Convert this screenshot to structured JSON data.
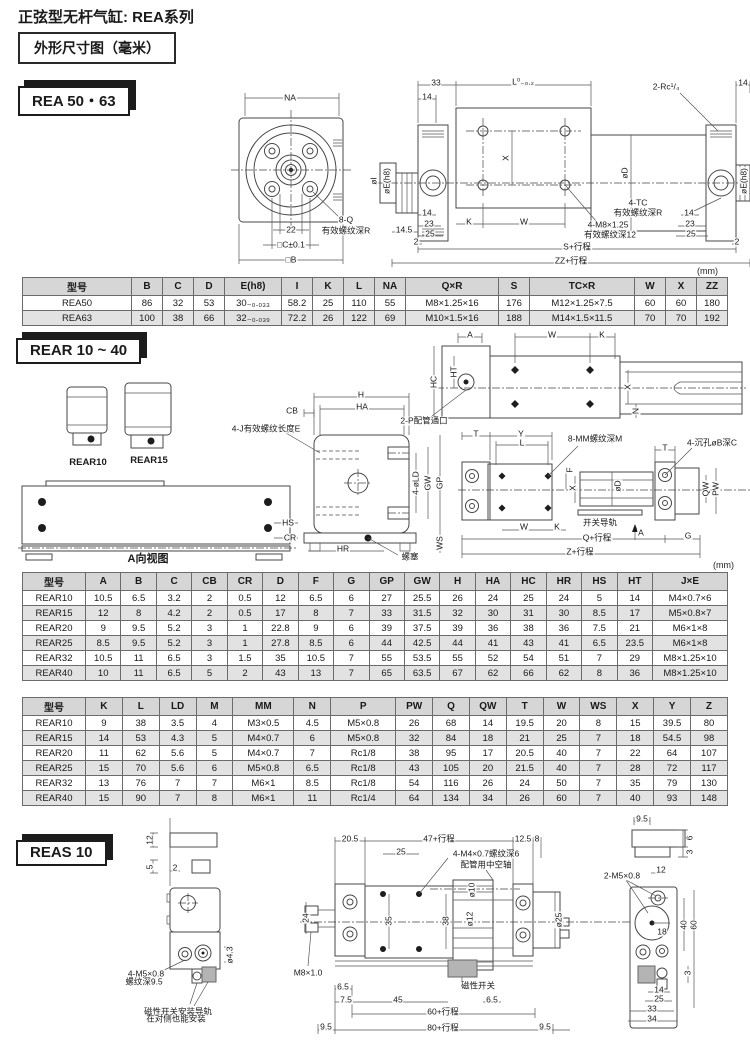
{
  "page": {
    "title": "正弦型无杆气缸: REA系列",
    "frame_title": "外形尺寸图（毫米）"
  },
  "sections": {
    "rea": {
      "badge": "REA 50・63"
    },
    "rear": {
      "badge": "REAR 10 ~ 40"
    },
    "reas": {
      "badge": "REAS 10"
    }
  },
  "labels": {
    "rea_front": [
      {
        "t": "NA",
        "x": 97,
        "y": 16
      },
      {
        "t": "22",
        "x": 98,
        "y": 148
      },
      {
        "t": "□C±0.1",
        "x": 98,
        "y": 163
      },
      {
        "t": "□B",
        "x": 98,
        "y": 178
      },
      {
        "t": "8-Q",
        "x": 153,
        "y": 138
      },
      {
        "t": "有效螺纹深R",
        "x": 153,
        "y": 149
      }
    ],
    "rea_side": [
      {
        "t": "33",
        "x": 70,
        "y": 10
      },
      {
        "t": "14",
        "x": 61,
        "y": 24
      },
      {
        "t": "L⁰₋₀.₂",
        "x": 157,
        "y": 9
      },
      {
        "t": "2-Rc¹/₄",
        "x": 300,
        "y": 14
      },
      {
        "t": "14",
        "x": 377,
        "y": 10
      },
      {
        "t": "X",
        "x": 140,
        "y": 85,
        "r": 1
      },
      {
        "t": "øD",
        "x": 259,
        "y": 100,
        "r": 1
      },
      {
        "t": "øI",
        "x": 8,
        "y": 108,
        "r": 1
      },
      {
        "t": "øE(h8)",
        "x": 21,
        "y": 108,
        "r": 1
      },
      {
        "t": "øE(h8)",
        "x": 378,
        "y": 108,
        "r": 1
      },
      {
        "t": "4-TC",
        "x": 272,
        "y": 130
      },
      {
        "t": "有效螺纹深R",
        "x": 272,
        "y": 140
      },
      {
        "t": "4-M8×1.25",
        "x": 242,
        "y": 152
      },
      {
        "t": "有效螺纹深12",
        "x": 244,
        "y": 162
      },
      {
        "t": "14",
        "x": 61,
        "y": 140
      },
      {
        "t": "23",
        "x": 63,
        "y": 151
      },
      {
        "t": "25",
        "x": 64,
        "y": 161
      },
      {
        "t": "14.5",
        "x": 38,
        "y": 157
      },
      {
        "t": "2",
        "x": 50,
        "y": 169
      },
      {
        "t": "K",
        "x": 103,
        "y": 149
      },
      {
        "t": "W",
        "x": 158,
        "y": 149
      },
      {
        "t": "14",
        "x": 323,
        "y": 140
      },
      {
        "t": "23",
        "x": 324,
        "y": 151
      },
      {
        "t": "25",
        "x": 325,
        "y": 161
      },
      {
        "t": "2",
        "x": 371,
        "y": 169
      },
      {
        "t": "S+行程",
        "x": 211,
        "y": 174
      },
      {
        "t": "ZZ+行程",
        "x": 205,
        "y": 188
      }
    ],
    "rear_small": [
      {
        "t": "REAR10",
        "x": 33,
        "y": 88,
        "fs": 9.5,
        "b": 1
      },
      {
        "t": "REAR15",
        "x": 94,
        "y": 86,
        "fs": 9.5,
        "b": 1
      }
    ],
    "rear_aview": [
      {
        "t": "HS",
        "x": 270,
        "y": 47
      },
      {
        "t": "CR",
        "x": 272,
        "y": 62
      },
      {
        "t": "A向视图",
        "x": 130,
        "y": 84,
        "fs": 11,
        "b": 1
      }
    ],
    "rear_body": [
      {
        "t": "H",
        "x": 65,
        "y": 12
      },
      {
        "t": "HA",
        "x": 66,
        "y": 24
      },
      {
        "t": "CB",
        "x": -4,
        "y": 28
      },
      {
        "t": "4-J有效螺纹长度E",
        "x": -30,
        "y": 46
      },
      {
        "t": "4-øLD",
        "x": 120,
        "y": 100,
        "r": 1
      },
      {
        "t": "GW",
        "x": 132,
        "y": 100,
        "r": 1
      },
      {
        "t": "GP",
        "x": 144,
        "y": 100,
        "r": 1
      },
      {
        "t": "WS",
        "x": 144,
        "y": 160,
        "r": 1
      },
      {
        "t": "HR",
        "x": 47,
        "y": 166
      },
      {
        "t": "螺塞",
        "x": 114,
        "y": 174
      }
    ],
    "rear_top": [
      {
        "t": "A",
        "x": 30,
        "y": 5
      },
      {
        "t": "W",
        "x": 112,
        "y": 5
      },
      {
        "t": "K",
        "x": 162,
        "y": 5
      },
      {
        "t": "HC",
        "x": -6,
        "y": 52,
        "r": 1
      },
      {
        "t": "HT",
        "x": 14,
        "y": 42,
        "r": 1
      },
      {
        "t": "X",
        "x": 188,
        "y": 57,
        "r": 1
      },
      {
        "t": "N",
        "x": 196,
        "y": 81,
        "r": 1
      },
      {
        "t": "2-P配管通口",
        "x": -16,
        "y": 91
      }
    ],
    "rear_bottom": [
      {
        "t": "T",
        "x": 16,
        "y": 8
      },
      {
        "t": "Y",
        "x": 61,
        "y": 8
      },
      {
        "t": "L",
        "x": 62,
        "y": 17
      },
      {
        "t": "8-MM螺纹深M",
        "x": 135,
        "y": 13
      },
      {
        "t": "T",
        "x": 205,
        "y": 22
      },
      {
        "t": "4-沉孔øB深C",
        "x": 252,
        "y": 17
      },
      {
        "t": "F",
        "x": 110,
        "y": 44,
        "r": 1
      },
      {
        "t": "X",
        "x": 113,
        "y": 62,
        "r": 1
      },
      {
        "t": "øD",
        "x": 158,
        "y": 60,
        "r": 1
      },
      {
        "t": "QW",
        "x": 246,
        "y": 63,
        "r": 1
      },
      {
        "t": "PW",
        "x": 256,
        "y": 63,
        "r": 1
      },
      {
        "t": "W",
        "x": 64,
        "y": 101
      },
      {
        "t": "K",
        "x": 97,
        "y": 101
      },
      {
        "t": "开关导轨",
        "x": 140,
        "y": 97
      },
      {
        "t": "A",
        "x": 181,
        "y": 107
      },
      {
        "t": "G",
        "x": 228,
        "y": 110
      },
      {
        "t": "Q+行程",
        "x": 137,
        "y": 112
      },
      {
        "t": "Z+行程",
        "x": 120,
        "y": 126
      }
    ],
    "reas_left": [
      {
        "t": "12",
        "x": 0,
        "y": 24,
        "r": 1
      },
      {
        "t": "5",
        "x": 0,
        "y": 51,
        "r": 1
      },
      {
        "t": "2",
        "x": 25,
        "y": 52
      },
      {
        "t": "ø4.3",
        "x": 80,
        "y": 139,
        "r": 1
      },
      {
        "t": "4-M5×0.8",
        "x": -4,
        "y": 158
      },
      {
        "t": "螺纹深9.5",
        "x": -6,
        "y": 166
      },
      {
        "t": "磁性开关安装导轨",
        "x": 28,
        "y": 196
      },
      {
        "t": "在对侧也能安装",
        "x": 26,
        "y": 203
      }
    ],
    "reas_mid": [
      {
        "t": "20.5",
        "x": 50,
        "y": 11
      },
      {
        "t": "47+行程",
        "x": 139,
        "y": 11
      },
      {
        "t": "12.5",
        "x": 223,
        "y": 11
      },
      {
        "t": "8",
        "x": 237,
        "y": 11
      },
      {
        "t": "25",
        "x": 101,
        "y": 24
      },
      {
        "t": "4-M4×0.7螺纹深6",
        "x": 186,
        "y": 26
      },
      {
        "t": "配管用中空轴",
        "x": 186,
        "y": 37
      },
      {
        "t": "ø10",
        "x": 172,
        "y": 62,
        "r": 1
      },
      {
        "t": "ø12",
        "x": 170,
        "y": 91,
        "r": 1
      },
      {
        "t": "24",
        "x": 6,
        "y": 90,
        "r": 1
      },
      {
        "t": "35",
        "x": 89,
        "y": 93,
        "r": 1
      },
      {
        "t": "38",
        "x": 146,
        "y": 93,
        "r": 1
      },
      {
        "t": "ø25",
        "x": 259,
        "y": 92,
        "r": 1
      },
      {
        "t": "M8×1.0",
        "x": 8,
        "y": 145
      },
      {
        "t": "6.5",
        "x": 43,
        "y": 159
      },
      {
        "t": "7.5",
        "x": 46,
        "y": 172
      },
      {
        "t": "45",
        "x": 98,
        "y": 172
      },
      {
        "t": "磁性开关",
        "x": 178,
        "y": 158
      },
      {
        "t": "6.5",
        "x": 192,
        "y": 172
      },
      {
        "t": "60+行程",
        "x": 143,
        "y": 184
      },
      {
        "t": "80+行程",
        "x": 143,
        "y": 200
      },
      {
        "t": "9.5",
        "x": 26,
        "y": 199
      },
      {
        "t": "9.5",
        "x": 245,
        "y": 199
      }
    ],
    "reas_right": [
      {
        "t": "9.5",
        "x": 30,
        "y": 6
      },
      {
        "t": "6",
        "x": 78,
        "y": 25,
        "r": 1
      },
      {
        "t": "3",
        "x": 78,
        "y": 39,
        "r": 1
      },
      {
        "t": "2-M5×0.8",
        "x": 10,
        "y": 63
      },
      {
        "t": "12",
        "x": 49,
        "y": 57
      },
      {
        "t": "40",
        "x": 72,
        "y": 112,
        "r": 1
      },
      {
        "t": "60",
        "x": 82,
        "y": 112,
        "r": 1
      },
      {
        "t": "18",
        "x": 50,
        "y": 119
      },
      {
        "t": "3",
        "x": 76,
        "y": 160,
        "r": 1
      },
      {
        "t": "14",
        "x": 47,
        "y": 177
      },
      {
        "t": "25",
        "x": 47,
        "y": 186
      },
      {
        "t": "33",
        "x": 40,
        "y": 196
      },
      {
        "t": "34",
        "x": 40,
        "y": 206
      }
    ]
  },
  "tables": [
    {
      "unit": "(mm)",
      "headers": [
        "型号",
        "B",
        "C",
        "D",
        "E(h8)",
        "I",
        "K",
        "L",
        "NA",
        "Q×R",
        "S",
        "TC×R",
        "W",
        "X",
        "ZZ"
      ],
      "rows": [
        [
          "REA50",
          "86",
          "32",
          "53",
          "30₋₀.₀₃₃",
          "58.2",
          "25",
          "110",
          "55",
          "M8×1.25×16",
          "176",
          "M12×1.25×7.5",
          "60",
          "60",
          "180"
        ],
        [
          "REA63",
          "100",
          "38",
          "66",
          "32₋₀.₀₃₉",
          "72.2",
          "26",
          "122",
          "69",
          "M10×1.5×16",
          "188",
          "M14×1.5×11.5",
          "70",
          "70",
          "192"
        ]
      ]
    },
    {
      "unit": "(mm)",
      "headers": [
        "型号",
        "A",
        "B",
        "C",
        "CB",
        "CR",
        "D",
        "F",
        "G",
        "GP",
        "GW",
        "H",
        "HA",
        "HC",
        "HR",
        "HS",
        "HT",
        "J×E"
      ],
      "rows": [
        [
          "REAR10",
          "10.5",
          "6.5",
          "3.2",
          "2",
          "0.5",
          "12",
          "6.5",
          "6",
          "27",
          "25.5",
          "26",
          "24",
          "25",
          "24",
          "5",
          "14",
          "M4×0.7×6"
        ],
        [
          "REAR15",
          "12",
          "8",
          "4.2",
          "2",
          "0.5",
          "17",
          "8",
          "7",
          "33",
          "31.5",
          "32",
          "30",
          "31",
          "30",
          "8.5",
          "17",
          "M5×0.8×7"
        ],
        [
          "REAR20",
          "9",
          "9.5",
          "5.2",
          "3",
          "1",
          "22.8",
          "9",
          "6",
          "39",
          "37.5",
          "39",
          "36",
          "38",
          "36",
          "7.5",
          "21",
          "M6×1×8"
        ],
        [
          "REAR25",
          "8.5",
          "9.5",
          "5.2",
          "3",
          "1",
          "27.8",
          "8.5",
          "6",
          "44",
          "42.5",
          "44",
          "41",
          "43",
          "41",
          "6.5",
          "23.5",
          "M6×1×8"
        ],
        [
          "REAR32",
          "10.5",
          "11",
          "6.5",
          "3",
          "1.5",
          "35",
          "10.5",
          "7",
          "55",
          "53.5",
          "55",
          "52",
          "54",
          "51",
          "7",
          "29",
          "M8×1.25×10"
        ],
        [
          "REAR40",
          "10",
          "11",
          "6.5",
          "5",
          "2",
          "43",
          "13",
          "7",
          "65",
          "63.5",
          "67",
          "62",
          "66",
          "62",
          "8",
          "36",
          "M8×1.25×10"
        ]
      ]
    },
    {
      "unit": "",
      "headers": [
        "型号",
        "K",
        "L",
        "LD",
        "M",
        "MM",
        "N",
        "P",
        "PW",
        "Q",
        "QW",
        "T",
        "W",
        "WS",
        "X",
        "Y",
        "Z"
      ],
      "rows": [
        [
          "REAR10",
          "9",
          "38",
          "3.5",
          "4",
          "M3×0.5",
          "4.5",
          "M5×0.8",
          "26",
          "68",
          "14",
          "19.5",
          "20",
          "8",
          "15",
          "39.5",
          "80"
        ],
        [
          "REAR15",
          "14",
          "53",
          "4.3",
          "5",
          "M4×0.7",
          "6",
          "M5×0.8",
          "32",
          "84",
          "18",
          "21",
          "25",
          "7",
          "18",
          "54.5",
          "98"
        ],
        [
          "REAR20",
          "11",
          "62",
          "5.6",
          "5",
          "M4×0.7",
          "7",
          "Rc1/8",
          "38",
          "95",
          "17",
          "20.5",
          "40",
          "7",
          "22",
          "64",
          "107"
        ],
        [
          "REAR25",
          "15",
          "70",
          "5.6",
          "6",
          "M5×0.8",
          "6.5",
          "Rc1/8",
          "43",
          "105",
          "20",
          "21.5",
          "40",
          "7",
          "28",
          "72",
          "117"
        ],
        [
          "REAR32",
          "13",
          "76",
          "7",
          "7",
          "M6×1",
          "8.5",
          "Rc1/8",
          "54",
          "116",
          "26",
          "24",
          "50",
          "7",
          "35",
          "79",
          "130"
        ],
        [
          "REAR40",
          "15",
          "90",
          "7",
          "8",
          "M6×1",
          "11",
          "Rc1/4",
          "64",
          "134",
          "34",
          "26",
          "60",
          "7",
          "40",
          "93",
          "148"
        ]
      ]
    }
  ]
}
